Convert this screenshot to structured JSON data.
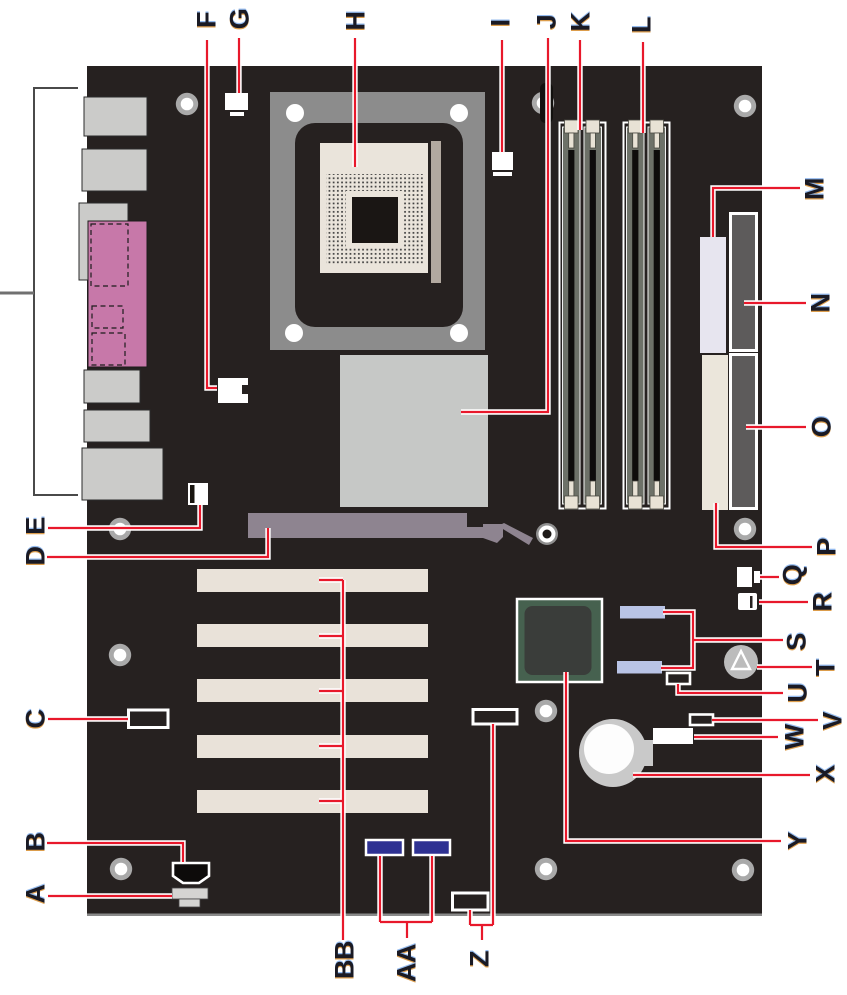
{
  "callout_labels": {
    "A": "A",
    "B": "B",
    "C": "C",
    "D": "D",
    "E": "E",
    "F": "F",
    "G": "G",
    "H": "H",
    "I": "I",
    "J": "J",
    "K": "K",
    "L": "L",
    "M": "M",
    "N": "N",
    "O": "O",
    "P": "P",
    "Q": "Q",
    "R": "R",
    "S": "S",
    "T": "T",
    "U": "U",
    "V": "V",
    "W": "W",
    "X": "X",
    "Y": "Y",
    "Z": "Z",
    "AA": "AA",
    "BB": "BB"
  },
  "colors": {
    "leader_line_red": "#e8182b",
    "board_black": "#262120",
    "label_text": "#1a1a24",
    "back_panel_connector_gray": "#cbcbc9",
    "back_panel_audio_pink": "#c778a9",
    "cpu_retention_frame_gray": "#8c8c8c",
    "cpu_socket_beige": "#eae4db",
    "heatsink_gray": "#c6c8c6",
    "agp_slot_mauve": "#8e8490",
    "pci_slot_beige": "#e9e2d9",
    "dimm_slot_gray": "#6d7168",
    "dimm_latch_beige": "#e8e2d5",
    "power_connector_lavender": "#e7e5ef",
    "ide_connector_dark": "#5d5b5b",
    "floppy_connector_cream": "#ebe6db",
    "chipset_frame_green": "#46614f",
    "chipset_die_dark": "#3a3d3a",
    "sata_connector_blue": "#b9c4e6",
    "usb_header_navy": "#2e3192",
    "battery_gray": "#c9c9c9",
    "speaker_gray": "#bcbcbc"
  }
}
